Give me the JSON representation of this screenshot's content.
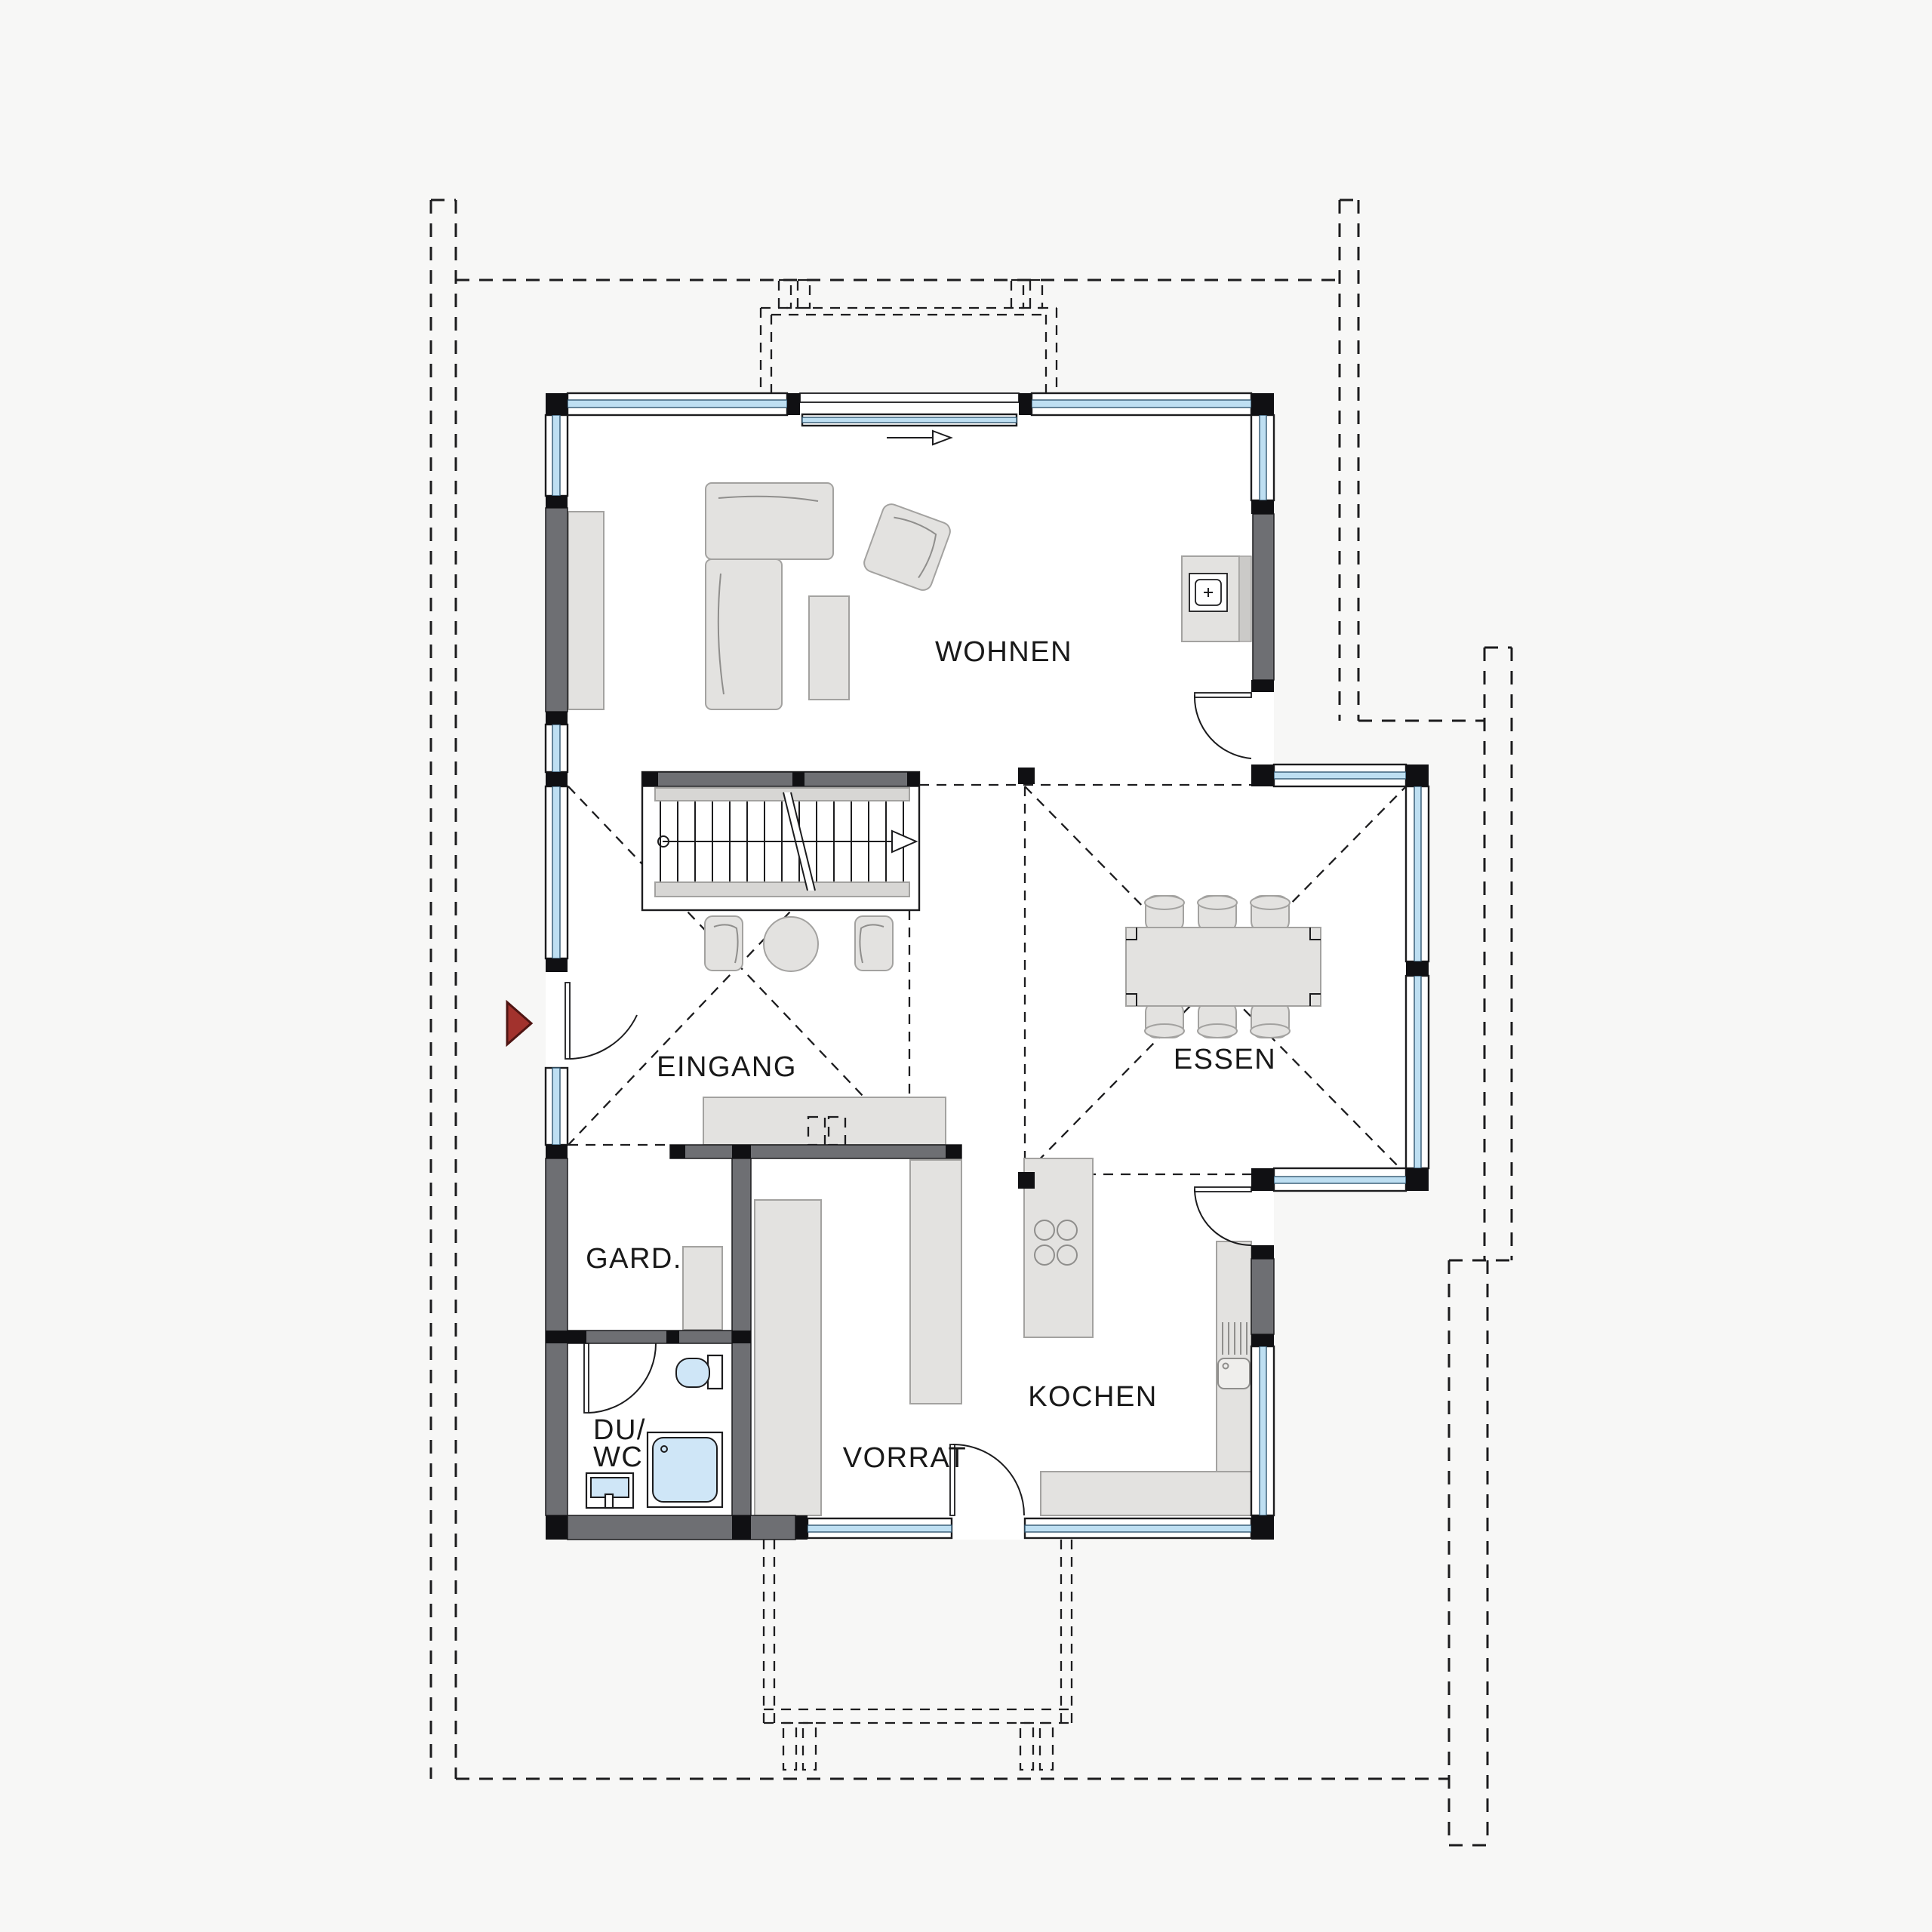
{
  "plan": {
    "type": "floor-plan",
    "floor": "ground-floor",
    "rooms": {
      "wohnen": "WOHNEN",
      "essen": "ESSEN",
      "eingang": "EINGANG",
      "gard": "GARD.",
      "du": "DU/",
      "wc": "WC",
      "vorrat": "VORRAT",
      "kochen": "KOCHEN"
    },
    "icons": [
      "entrance-arrow-icon",
      "fireplace-icon",
      "cooktop-icon",
      "sink-icon",
      "shower-icon",
      "toilet-icon",
      "washbasin-icon",
      "stair-icon",
      "dining-table-icon",
      "sofa-icon",
      "door-swing-icon"
    ],
    "colors": {
      "background": "#f7f7f6",
      "wall_black": "#101013",
      "wall_gray": "#6e6f73",
      "window_glass": "#bedff2",
      "furniture_light": "#e3e2e0",
      "fixture_blue": "#cfe6f7",
      "entrance_arrow_red": "#a2322d",
      "line": "#1c1c1e"
    }
  }
}
